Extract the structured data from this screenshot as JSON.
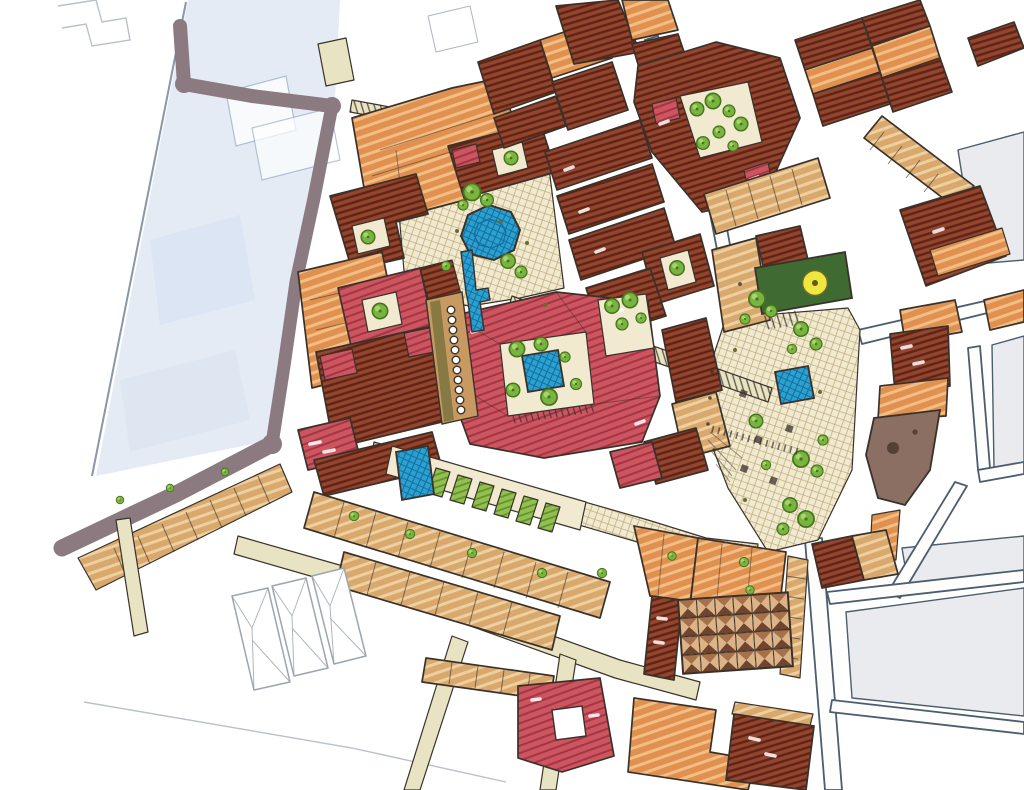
{
  "artwork": {
    "title": "Hand-drawn urban masterplan sketch, plan view, marker and ink",
    "visible_text": "none"
  },
  "palette": {
    "paper": "#fdfdfc",
    "ink": "#3a322a",
    "street_ink": "#4c5d6e",
    "pale_blue": "#e4ebf5",
    "pale_blue_deep": "#d6e0f0",
    "gray_block": "#e9ebee",
    "road_taupe": "#8b7b80",
    "street_beige": "#e8e3c2",
    "plaza_cream": "#f1ead0",
    "plaza_hatch": "#bfae80",
    "roof_maroon": "#93452f",
    "roof_maroon_dark": "#5e2414",
    "roof_red": "#cd5560",
    "roof_red_dark": "#a23644",
    "roof_orange": "#e0914f",
    "roof_orange_light": "#f3bd86",
    "roof_tan": "#d8a86d",
    "roof_tan_light": "#edcfa0",
    "colonnade_tan": "#c89a62",
    "tree_green": "#79b340",
    "tree_dark": "#47741d",
    "tree_light": "#abd871",
    "garden_green": "#92bf4f",
    "garden_dark": "#5e8f2a",
    "water_blue": "#2ba1d1",
    "water_dark": "#156f9e",
    "green_roof": "#3f6a31",
    "yellow_accent": "#efe73e",
    "taupe_brown": "#8a6f62",
    "taupe_brown_dark": "#544034",
    "pyr_light": "#dcb488",
    "pyr_mid": "#a5714a",
    "pyr_dark": "#6f4530"
  },
  "features": {
    "description": "Dense historic town core drawn diagonally across the sheet; pale blue wash block upper-left; unpainted outline parcels lower-left and right.",
    "plazas": [
      "north fountain plaza",
      "central market street",
      "east tree plaza"
    ],
    "water": {
      "octagonal_fountain_with_runnel": 1,
      "courtyard_pool": 1,
      "east_plaza_pool": 1,
      "garden_pool": 1,
      "color_ref": "water_blue"
    },
    "vegetation": {
      "trees_and_bushes": 52,
      "garden_plots": 6,
      "color_ref": "tree_green"
    },
    "buildings": {
      "red_hatched_roof_blocks": "perimeter blocks with courtyards",
      "orange_roof_blocks": "large stepped roofs",
      "tan_row_houses": "strips along streets",
      "market_hall_pyramid_grid": {
        "cols": 6,
        "rows": 4
      },
      "green_roof_hall_with_oculus": 1,
      "curved_taupe_building": 1,
      "colonnade_columns": 11
    },
    "roads": [
      "taupe boulevard ring west and south",
      "beige lanes south",
      "white outlined streets east"
    ],
    "legend": "no text labels visible on the drawing"
  }
}
